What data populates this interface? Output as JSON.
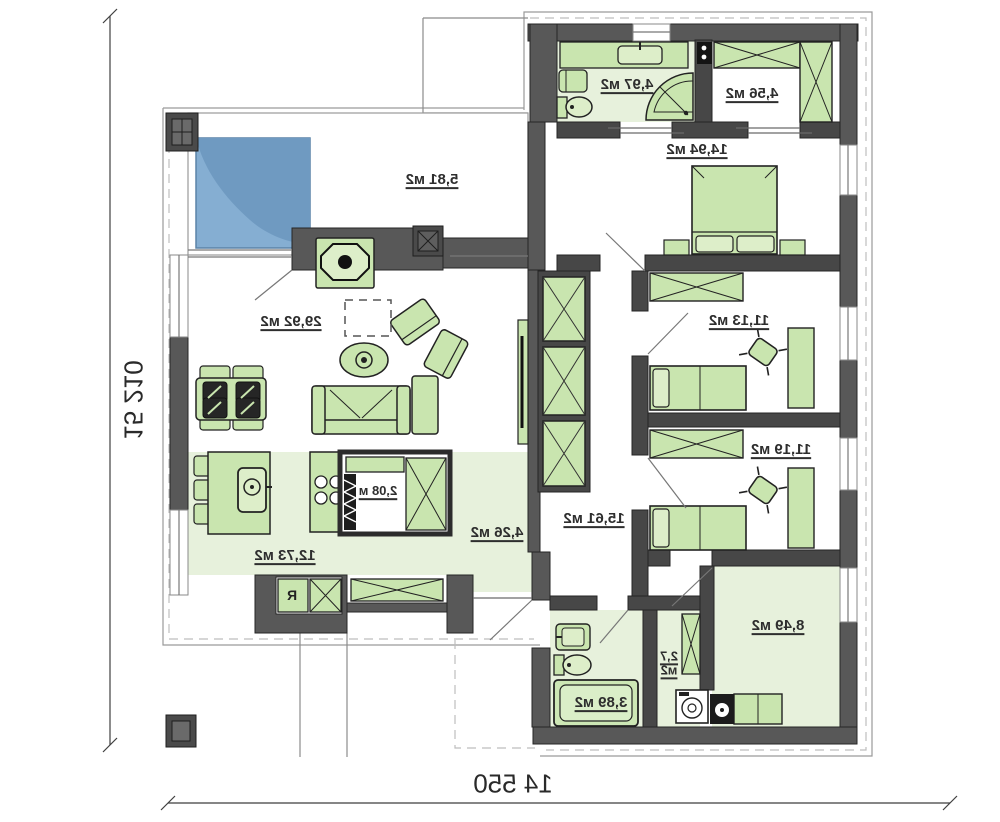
{
  "plan_type": "floor-plan-mirrored",
  "dimensions": {
    "bottom": "14 550",
    "left": "15 210"
  },
  "rooms": {
    "terrace": {
      "label": "5,81 м2"
    },
    "bath_top": {
      "label": "4,97 м2"
    },
    "dressing": {
      "label": "4,56 м2"
    },
    "bedroom_main": {
      "label": "14,94 м2"
    },
    "bedroom_one": {
      "label": "11,13 м2"
    },
    "bedroom_two": {
      "label": "11,19 м2"
    },
    "living": {
      "label": "29,92 м2"
    },
    "pantry": {
      "label": "2,08 м"
    },
    "kitchen": {
      "label": "12,73 м2"
    },
    "hall": {
      "label": "4,26 м2"
    },
    "corridor": {
      "label": "15,61 м2"
    },
    "bathroom": {
      "label": "3,89 м2"
    },
    "wc": {
      "line1": "2,7",
      "line2": "м2"
    },
    "utility": {
      "label": "8,49 м2"
    }
  },
  "labels": {
    "fridge": "R"
  },
  "palette": {
    "wall": "#585858",
    "inner_wall": "#474747",
    "furniture": "#c9e5af",
    "furniture_light": "#ddeec9",
    "floor_tint": "#e7f1dc",
    "pool": "#7ba7ce",
    "pool_shade": "#6b96bb",
    "line": "#444444"
  }
}
